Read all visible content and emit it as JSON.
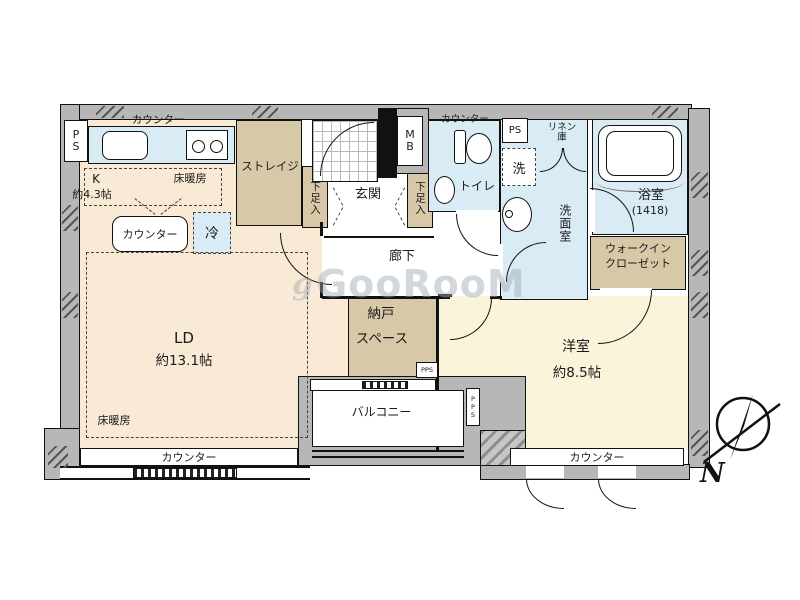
{
  "colors": {
    "floor_cream": "#f9ead5",
    "floor_pale_yellow": "#f9f4da",
    "closet_tan": "#d7c9a7",
    "wet_area_blue": "#d9ecf5",
    "wall_gray": "#b7b7b7",
    "outline": "#111111",
    "watermark_gray": "#a0abb5"
  },
  "labels": {
    "kitchen": {
      "counter_top": "カウンター",
      "k": "K",
      "size": "約4.3帖",
      "floor_heating": "床暖房",
      "island_counter": "カウンター",
      "fridge": "冷",
      "pipe_space": "P\nS"
    },
    "storage_room": {
      "name": "ストレイジ"
    },
    "entrance": {
      "name": "玄関",
      "shoe_cabinet_left": "下足入",
      "shoe_cabinet_right": "下足入",
      "meter_box": "M\nB"
    },
    "toilet": {
      "name": "トイレ",
      "counter": "カウンター"
    },
    "washroom": {
      "name": "洗面室",
      "pipe_space": "PS",
      "washer": "洗",
      "linen_closet": "リネン\n庫"
    },
    "bathroom": {
      "name": "浴室",
      "size": "(1418)"
    },
    "walk_in_closet": {
      "line1": "ウォークイン",
      "line2": "クローゼット"
    },
    "hallway": {
      "name": "廊下"
    },
    "storage_space": {
      "line1": "納戸",
      "line2": "スペース",
      "pps": "PPS"
    },
    "living_dining": {
      "name": "LD",
      "size": "約13.1帖",
      "floor_heating": "床暖房",
      "counter": "カウンター"
    },
    "bedroom": {
      "name": "洋室",
      "size": "約8.5帖",
      "counter": "カウンター"
    },
    "balcony": {
      "name": "バルコニー",
      "pps": "PPS"
    },
    "compass": {
      "north": "N"
    },
    "watermark": {
      "logo": "g",
      "text": "GooRooM"
    }
  }
}
